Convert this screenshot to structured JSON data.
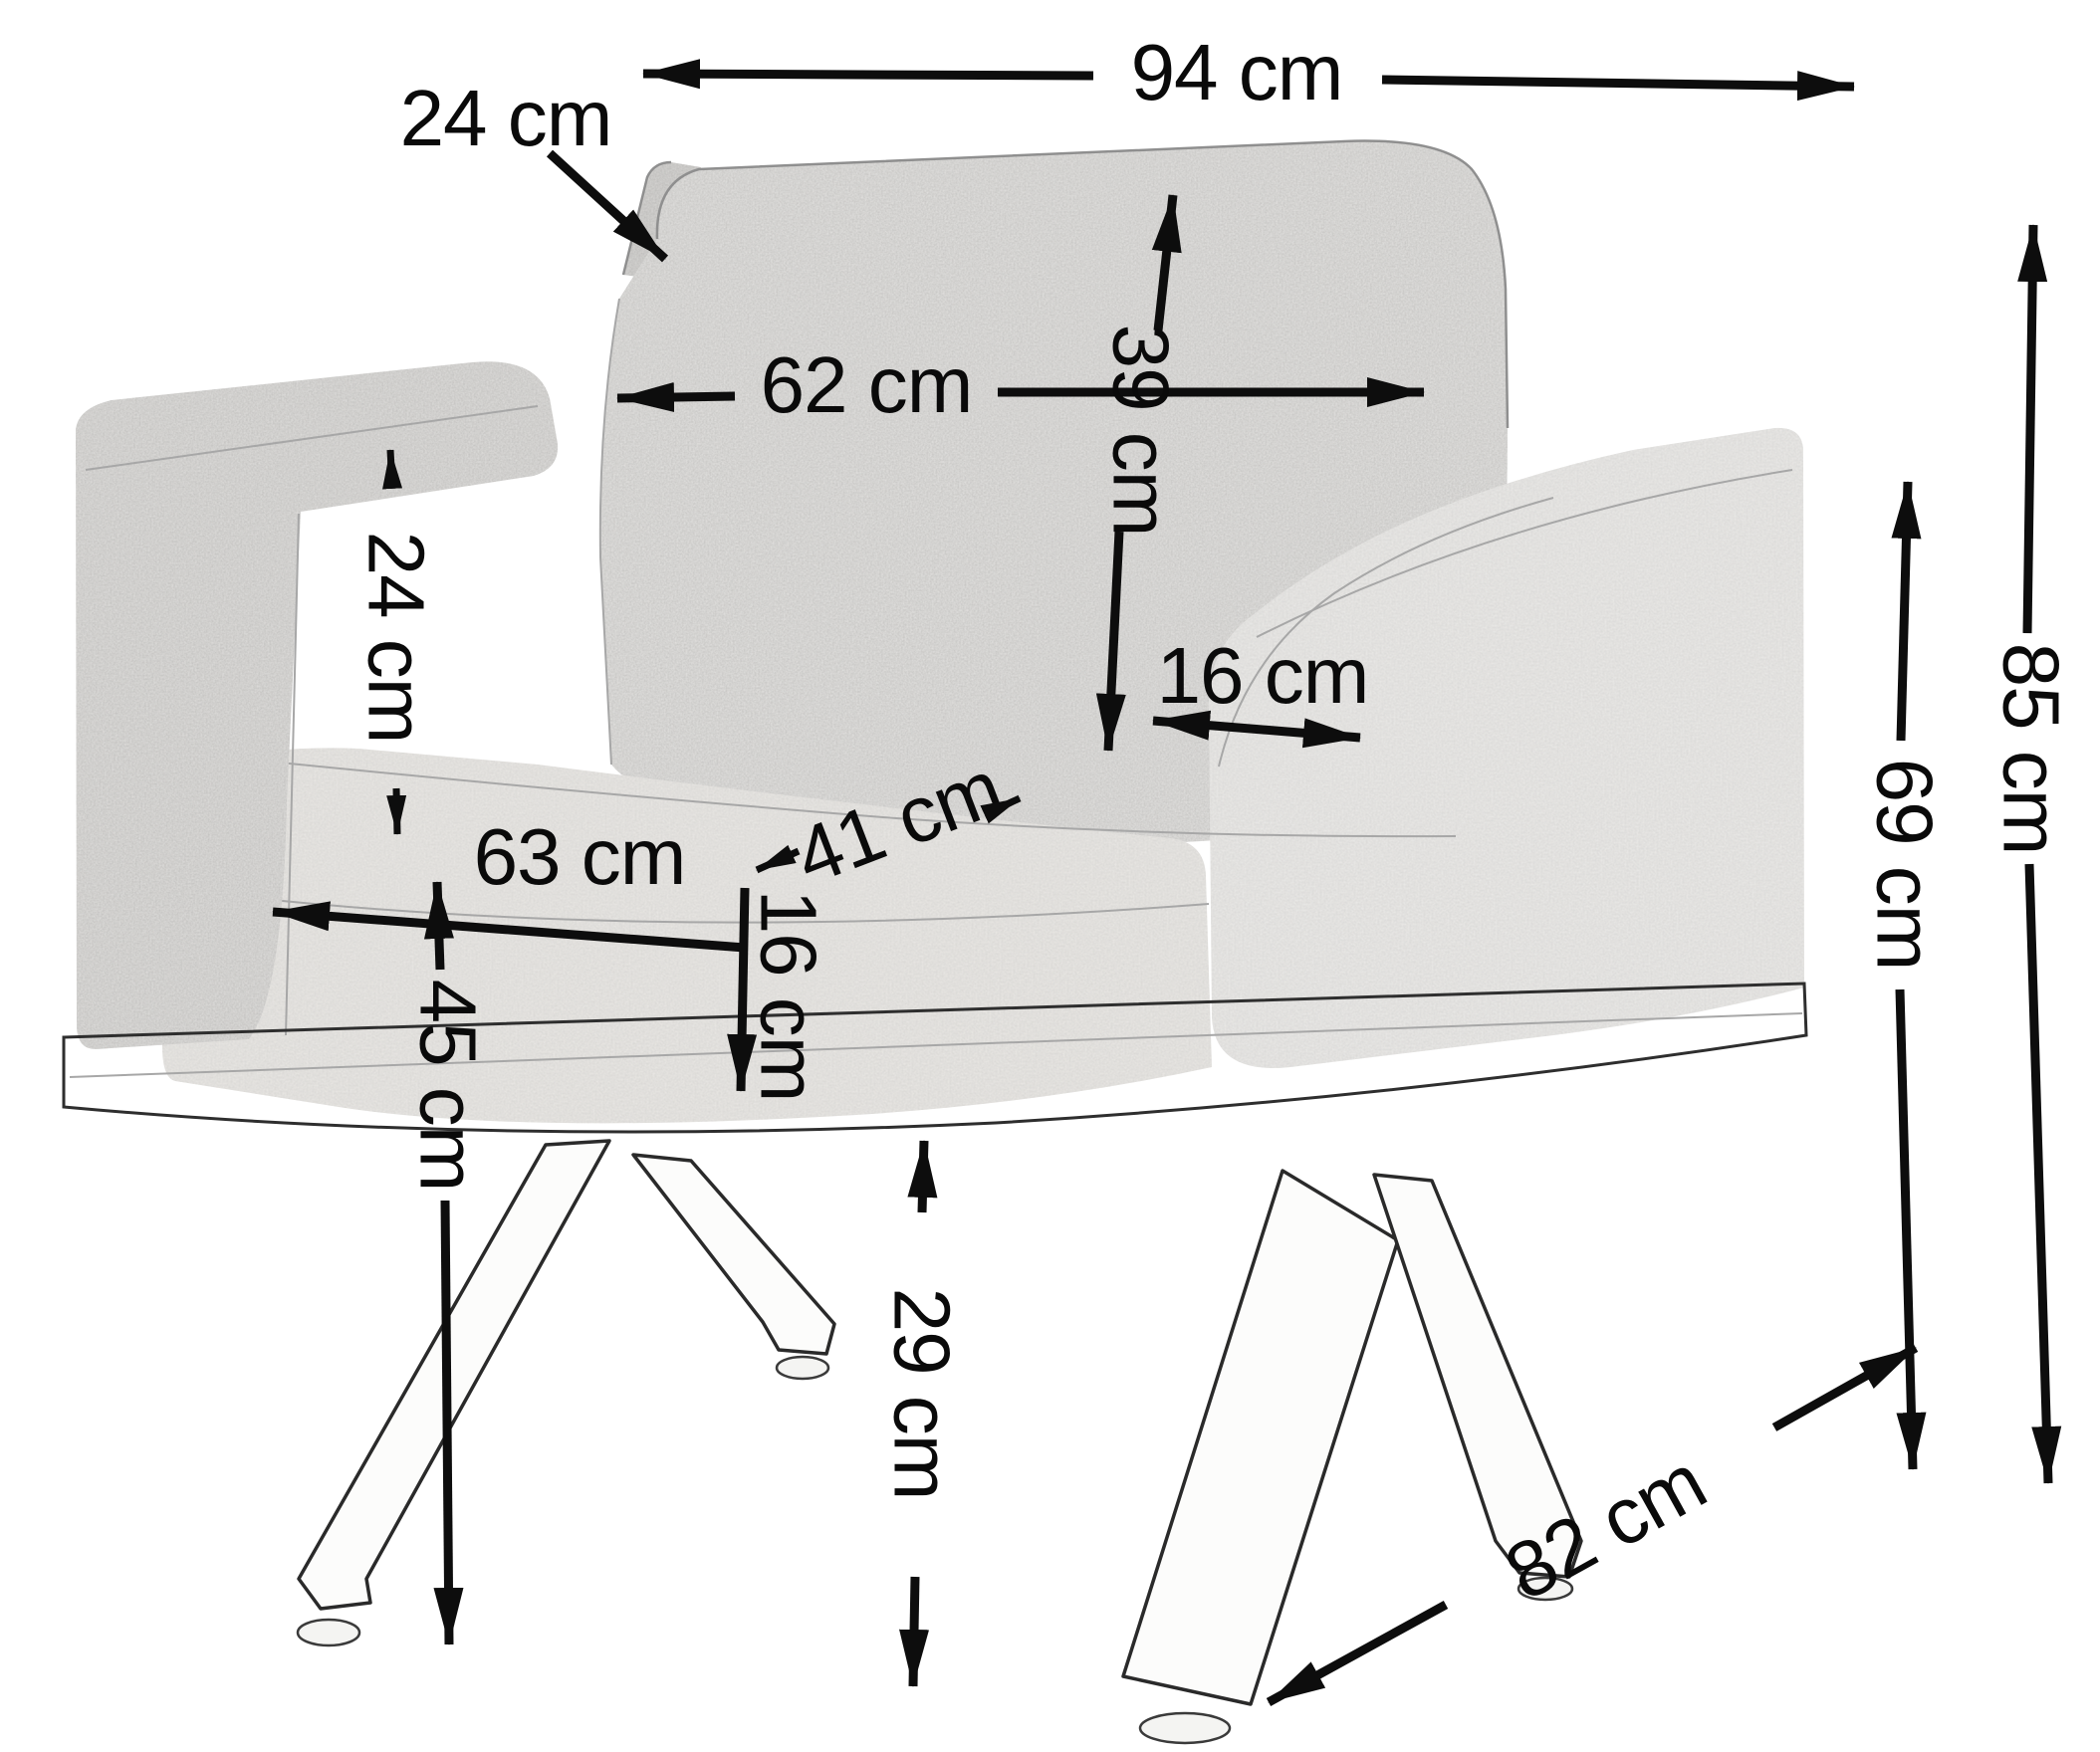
{
  "diagram": {
    "background_color": "#ffffff",
    "annotation_color": "#0d0d0d",
    "fabric_color": "#e7e6e4",
    "unit": "cm"
  },
  "dims": {
    "overall_width": {
      "value": 94,
      "unit": "cm",
      "label": "94 cm"
    },
    "back_pillow_thickness": {
      "value": 24,
      "unit": "cm",
      "label": "24 cm"
    },
    "back_pillow_width": {
      "value": 62,
      "unit": "cm",
      "label": "62 cm"
    },
    "back_pillow_height": {
      "value": 39,
      "unit": "cm",
      "label": "39 cm"
    },
    "armrest_top_depth": {
      "value": 24,
      "unit": "cm",
      "label": "24 cm"
    },
    "armrest_width": {
      "value": 16,
      "unit": "cm",
      "label": "16 cm"
    },
    "seat_depth": {
      "value": 41,
      "unit": "cm",
      "label": "41 cm"
    },
    "seat_width": {
      "value": 63,
      "unit": "cm",
      "label": "63 cm"
    },
    "seat_cushion_thickness": {
      "value": 16,
      "unit": "cm",
      "label": "16 cm"
    },
    "seat_height": {
      "value": 45,
      "unit": "cm",
      "label": "45 cm"
    },
    "base_clearance_height": {
      "value": 29,
      "unit": "cm",
      "label": "29 cm"
    },
    "armrest_height": {
      "value": 69,
      "unit": "cm",
      "label": "69 cm"
    },
    "overall_height": {
      "value": 85,
      "unit": "cm",
      "label": "85 cm"
    },
    "overall_depth": {
      "value": 82,
      "unit": "cm",
      "label": "82 cm"
    }
  }
}
